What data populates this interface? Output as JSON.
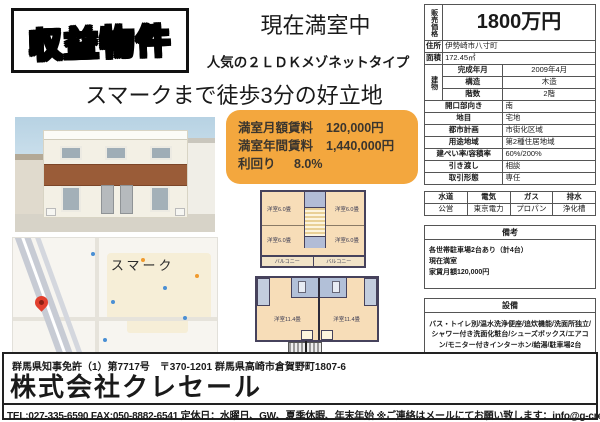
{
  "badge": {
    "label": "収益物件"
  },
  "headlines": {
    "status": "現在満室中",
    "subtitle": "人気の２ＬＤＫメゾネットタイプ",
    "location": "スマークまで徒歩3分の好立地"
  },
  "rent_box": {
    "rows": [
      {
        "label": "満室月額賃料",
        "value": "120,000円"
      },
      {
        "label": "満室年間賃料",
        "value": "1,440,000円"
      },
      {
        "label": "利回り",
        "value": "8.0%"
      }
    ]
  },
  "property_table": {
    "price_label": "販売価格",
    "price_value": "1800万円",
    "rows": [
      {
        "label": "住所",
        "value": "伊勢崎市八寸町"
      },
      {
        "label": "面積",
        "value": "172.45㎡"
      }
    ],
    "building_label": "建物",
    "building_rows": [
      {
        "label": "完成年月",
        "value": "2009年4月"
      },
      {
        "label": "構造",
        "value": "木造"
      },
      {
        "label": "階数",
        "value": "2階"
      }
    ],
    "rows2": [
      {
        "label": "開口部向き",
        "value": "南"
      },
      {
        "label": "地目",
        "value": "宅地"
      },
      {
        "label": "都市計画",
        "value": "市街化区域"
      },
      {
        "label": "用途地域",
        "value": "第2種住居地域"
      },
      {
        "label": "建ぺい率/容積率",
        "value": "60%/200%"
      },
      {
        "label": "引き渡し",
        "value": "相談"
      },
      {
        "label": "取引形態",
        "value": "専任"
      }
    ]
  },
  "utilities": {
    "headers": [
      "水道",
      "電気",
      "ガス",
      "排水"
    ],
    "values": [
      "公営",
      "東京電力",
      "プロパン",
      "浄化槽"
    ]
  },
  "remarks": {
    "title": "備考",
    "lines": [
      "各世帯駐車場2台あり（計4台）",
      "現在満室",
      "家賃月額120,000円"
    ]
  },
  "equipment": {
    "title": "設備",
    "text": "バス・トイレ別/温水洗浄便座/追炊機能/洗面所独立/シャワー付き洗面化粧台/シューズボックス/エアコン/モニター付きインターホン/給湯/駐車場2台"
  },
  "disclaimer": "※図面と現況が異なる場合は現況を優先させて頂きます。",
  "floorplan": {
    "upper_rooms": [
      "洋室6.0畳",
      "洋室6.0畳",
      "洋室6.0畳",
      "洋室6.0畳"
    ],
    "balcony_labels": [
      "バルコニー",
      "バルコニー"
    ],
    "lower_rooms": [
      "洋室11.4畳",
      "洋室11.4畳"
    ]
  },
  "map": {
    "landmark": "スマーク"
  },
  "footer": {
    "license": "群馬県知事免許（1）第7717号　〒370-1201 群馬県高崎市倉賀野町1807-6",
    "company": "株式会社クレセール",
    "contact": "TEL:027-335-6590  FAX:050-8882-6541  定休日：水曜日、GW、夏季休暇、年末年始  ※ご連絡はメールにてお願い致します：info@g-crecer.jp"
  },
  "colors": {
    "accent_orange": "#F3A73E",
    "pin_red": "#E2402F",
    "brown_band": "#9A5C38"
  }
}
